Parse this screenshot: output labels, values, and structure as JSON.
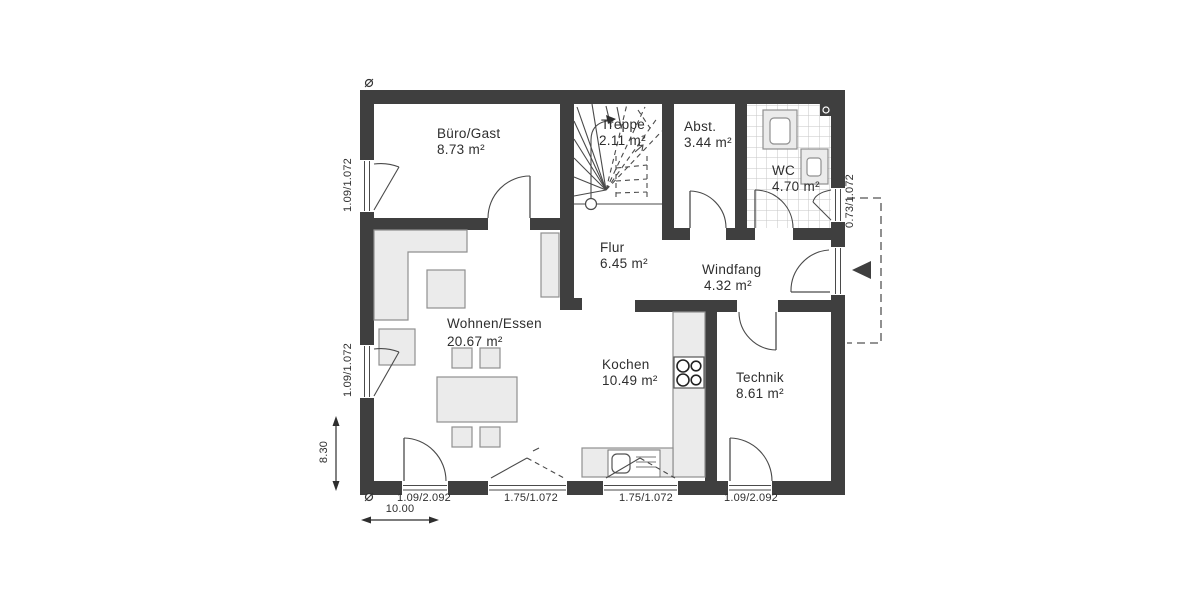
{
  "drawing": {
    "type": "floor-plan",
    "rooms": [
      {
        "name": "Büro/Gast",
        "area": "8.73 m²"
      },
      {
        "name": "Treppe",
        "area": "2.11 m²"
      },
      {
        "name": "Abst.",
        "area": "3.44 m²"
      },
      {
        "name": "WC",
        "area": "4.70 m²"
      },
      {
        "name": "Flur",
        "area": "6.45 m²"
      },
      {
        "name": "Windfang",
        "area": "4.32 m²"
      },
      {
        "name": "Wohnen/Essen",
        "area": "20.67 m²"
      },
      {
        "name": "Kochen",
        "area": "10.49 m²"
      },
      {
        "name": "Technik",
        "area": "8.61 m²"
      }
    ],
    "openings": {
      "left_window_top": "1.09/1.072",
      "left_window_bottom": "1.09/1.072",
      "right_wc_window": "0.73/1.072",
      "bottom_terrace_door": "1.09/2.092",
      "bottom_window_left": "1.75/1.072",
      "bottom_window_right": "1.75/1.072",
      "bottom_technik_door": "1.09/2.092"
    },
    "measurements": {
      "total_depth": "8.30",
      "total_width": "10.00"
    },
    "colors": {
      "wall": "#3f3f3f",
      "furniture_fill": "#ebebeb",
      "furniture_stroke": "#8f8f8f",
      "line": "#4a4a4a",
      "text": "#2e2e2e",
      "tile_line": "#c6c6c6",
      "background": "#ffffff"
    }
  }
}
